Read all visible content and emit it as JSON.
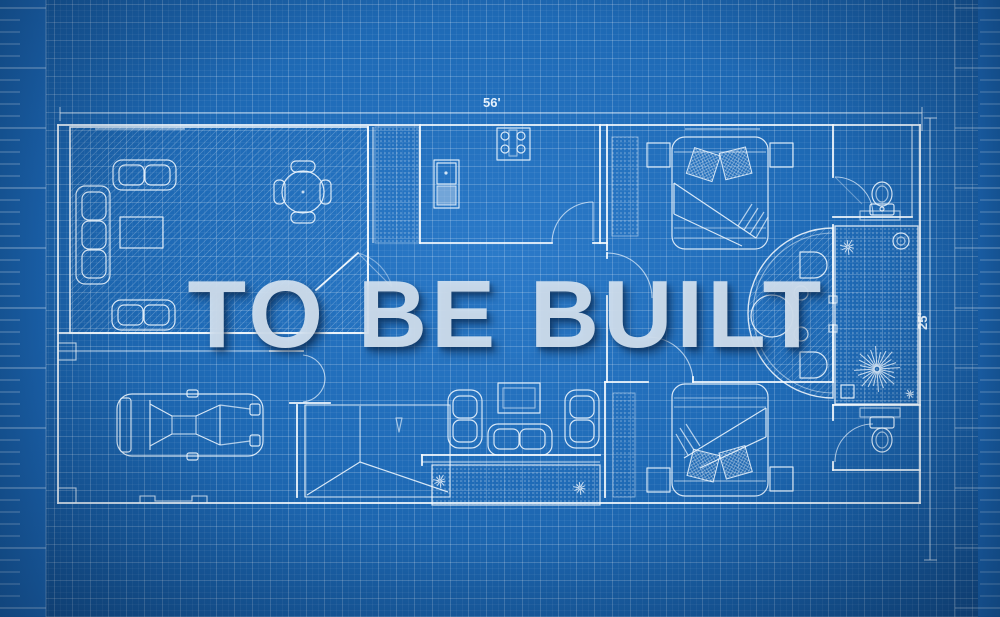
{
  "watermark": {
    "text": "TO BE BUILT"
  },
  "dimensions": {
    "width_label": "56'",
    "height_label": "25'"
  },
  "colors": {
    "paper_blue": "#1d68b4",
    "paper_blue_light": "#2b7ac9",
    "paper_blue_dark": "#124a85",
    "grid_line": "#5b94cd",
    "plan_line": "#f4faff",
    "watermark_text": "#d5e3f1"
  },
  "plan_elements": [
    "living-room",
    "dining-table",
    "kitchen",
    "mudroom",
    "bedroom-1",
    "bathroom-1",
    "patio",
    "deck",
    "bedroom-2",
    "bathroom-2",
    "family-room",
    "porch",
    "stairs",
    "garage",
    "car"
  ]
}
